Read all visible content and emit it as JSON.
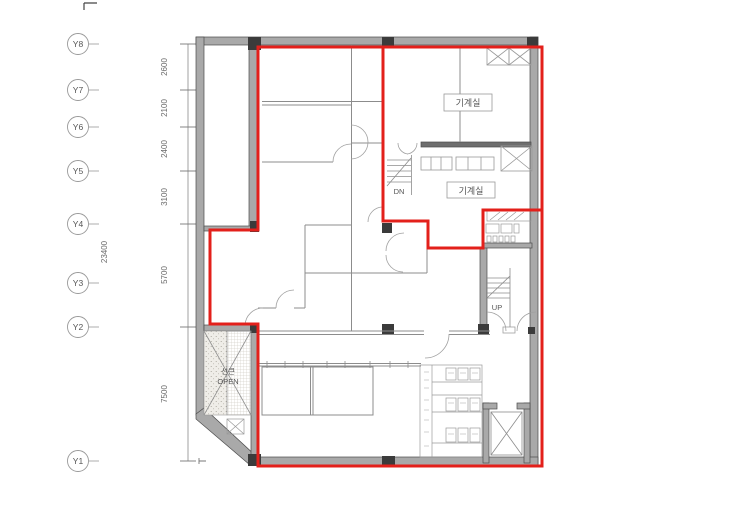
{
  "drawing": {
    "grid": {
      "labels": [
        "Y8",
        "Y7",
        "Y6",
        "Y5",
        "Y4",
        "Y3",
        "Y2",
        "Y1"
      ],
      "dims": [
        "2600",
        "2100",
        "2400",
        "3100",
        "5700",
        "7500"
      ],
      "total_dim": "23400"
    },
    "rooms": {
      "machine_room_upper": "기계실",
      "machine_room_lower": "기계실"
    },
    "stairs": {
      "down_label": "DN",
      "up_label": "UP"
    },
    "sunken": {
      "line1": "선큰",
      "line2": "OPEN"
    },
    "colors": {
      "boundary_red": "#e3201b",
      "wall_fill": "#a9a9a9",
      "wall_edge": "#4c4c4c",
      "column_dark": "#3b3b3b",
      "thin_line": "#8c8c8c",
      "text_gray": "#5a5a5a"
    }
  }
}
